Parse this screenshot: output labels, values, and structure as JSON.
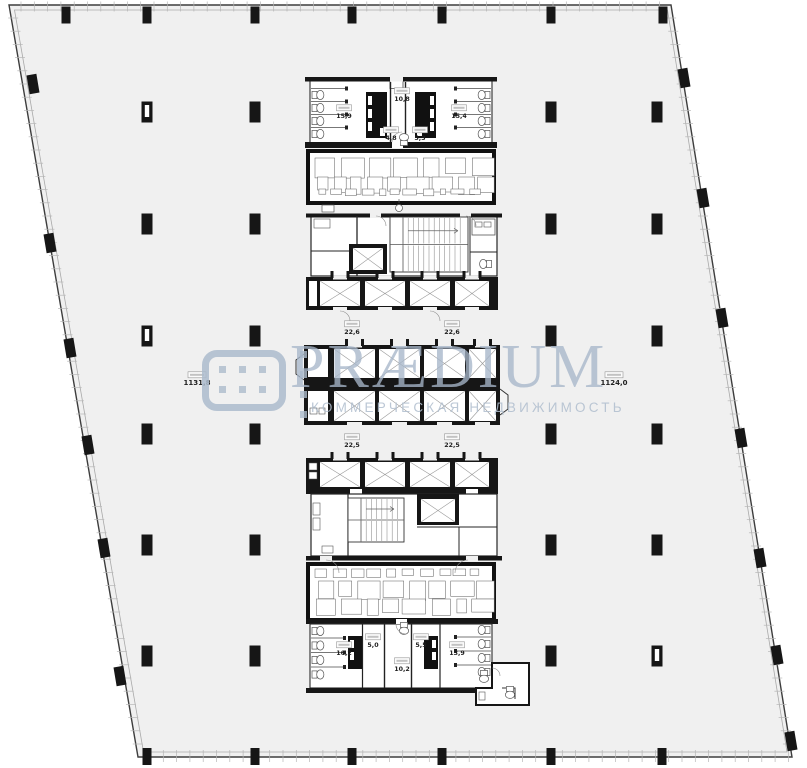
{
  "watermark": {
    "brand": "PRÆDIUM",
    "subtitle": "КОММЕРЧЕСКАЯ НЕДВИЖИМОСТЬ",
    "accent_color": "#acbbcc"
  },
  "area_labels": {
    "office_west": "1131,8",
    "office_east": "1124,0",
    "wc_top_left": "15,9",
    "lobby_top": "10,8",
    "wc_top_center_left": "4,8",
    "wc_top_center_right": "5,3",
    "wc_top_right": "15,4",
    "lift_upper_left": "22,6",
    "lift_upper_right": "22,6",
    "lift_lower_left": "22,5",
    "lift_lower_right": "22,5",
    "wc_bottom_left": "16,2",
    "wc_bottom_center_left": "5,0",
    "wc_bottom_center_right": "5,5",
    "wc_bottom_right": "13,9",
    "lobby_bottom": "10,2"
  },
  "plan": {
    "floor_fill": "#f0f0f0",
    "wall_color": "#161616",
    "outline": [
      [
        9,
        5
      ],
      [
        671,
        5
      ],
      [
        792,
        757
      ],
      [
        138,
        757
      ]
    ],
    "columns": {
      "interior": [
        [
          147,
          112,
          1
        ],
        [
          255,
          112
        ],
        [
          551,
          112
        ],
        [
          657,
          112
        ],
        [
          147,
          224
        ],
        [
          255,
          224
        ],
        [
          551,
          224
        ],
        [
          657,
          224
        ],
        [
          147,
          336,
          1
        ],
        [
          255,
          336
        ],
        [
          551,
          336
        ],
        [
          657,
          336
        ],
        [
          147,
          434
        ],
        [
          255,
          434
        ],
        [
          551,
          434
        ],
        [
          657,
          434
        ],
        [
          147,
          545
        ],
        [
          255,
          545
        ],
        [
          551,
          545
        ],
        [
          657,
          545
        ],
        [
          147,
          656
        ],
        [
          255,
          656
        ],
        [
          551,
          656
        ],
        [
          657,
          656,
          1
        ]
      ],
      "top_wall": [
        66,
        147,
        255,
        352,
        442,
        551,
        663
      ],
      "bottom_wall": [
        147,
        255,
        352,
        442,
        551,
        662
      ],
      "left_edge": [
        [
          33,
          84
        ],
        [
          50,
          243
        ],
        [
          70,
          348
        ],
        [
          88,
          445
        ],
        [
          104,
          548
        ],
        [
          120,
          676
        ]
      ],
      "right_edge": [
        [
          684,
          78
        ],
        [
          703,
          198
        ],
        [
          722,
          318
        ],
        [
          741,
          438
        ],
        [
          760,
          558
        ],
        [
          777,
          655
        ],
        [
          791,
          741
        ]
      ]
    }
  }
}
